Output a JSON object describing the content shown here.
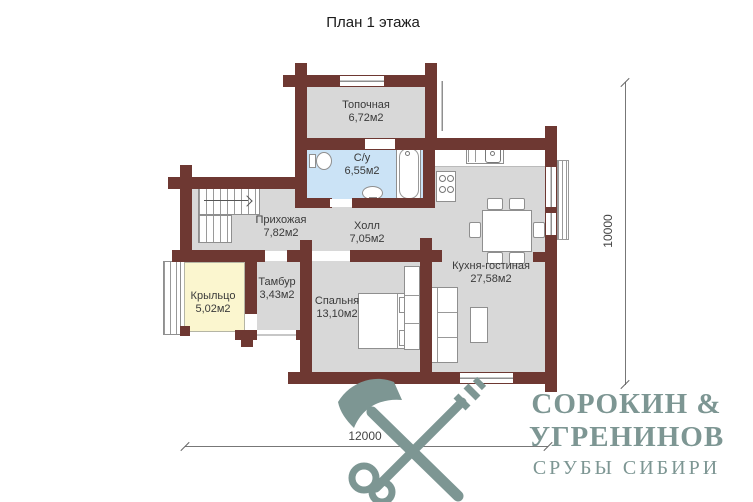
{
  "title": "План 1 этажа",
  "rooms": [
    {
      "name": "Топочная",
      "area": "6,72м2"
    },
    {
      "name": "С/у",
      "area": "6,55м2"
    },
    {
      "name": "Прихожая",
      "area": "7,82м2"
    },
    {
      "name": "Холл",
      "area": "7,05м2"
    },
    {
      "name": "Кухня-гостиная",
      "area": "27,58м2"
    },
    {
      "name": "Тамбур",
      "area": "3,43м2"
    },
    {
      "name": "Крыльцо",
      "area": "5,02м2"
    },
    {
      "name": "Спальня",
      "area": "13,10м2"
    }
  ],
  "dimensions": {
    "vertical": "10000",
    "horizontal": "12000"
  },
  "logo": {
    "line1": "СОРОКИН &",
    "line2": "УГРЕНИНОВ",
    "line3": "СРУБЫ СИБИРИ"
  },
  "colors": {
    "wall": "#6e3832",
    "room_fill": "#d8d8d8",
    "bathroom_fill": "#cbe3f6",
    "porch_fill": "#fbf6cf",
    "logo": "#7d9693"
  }
}
